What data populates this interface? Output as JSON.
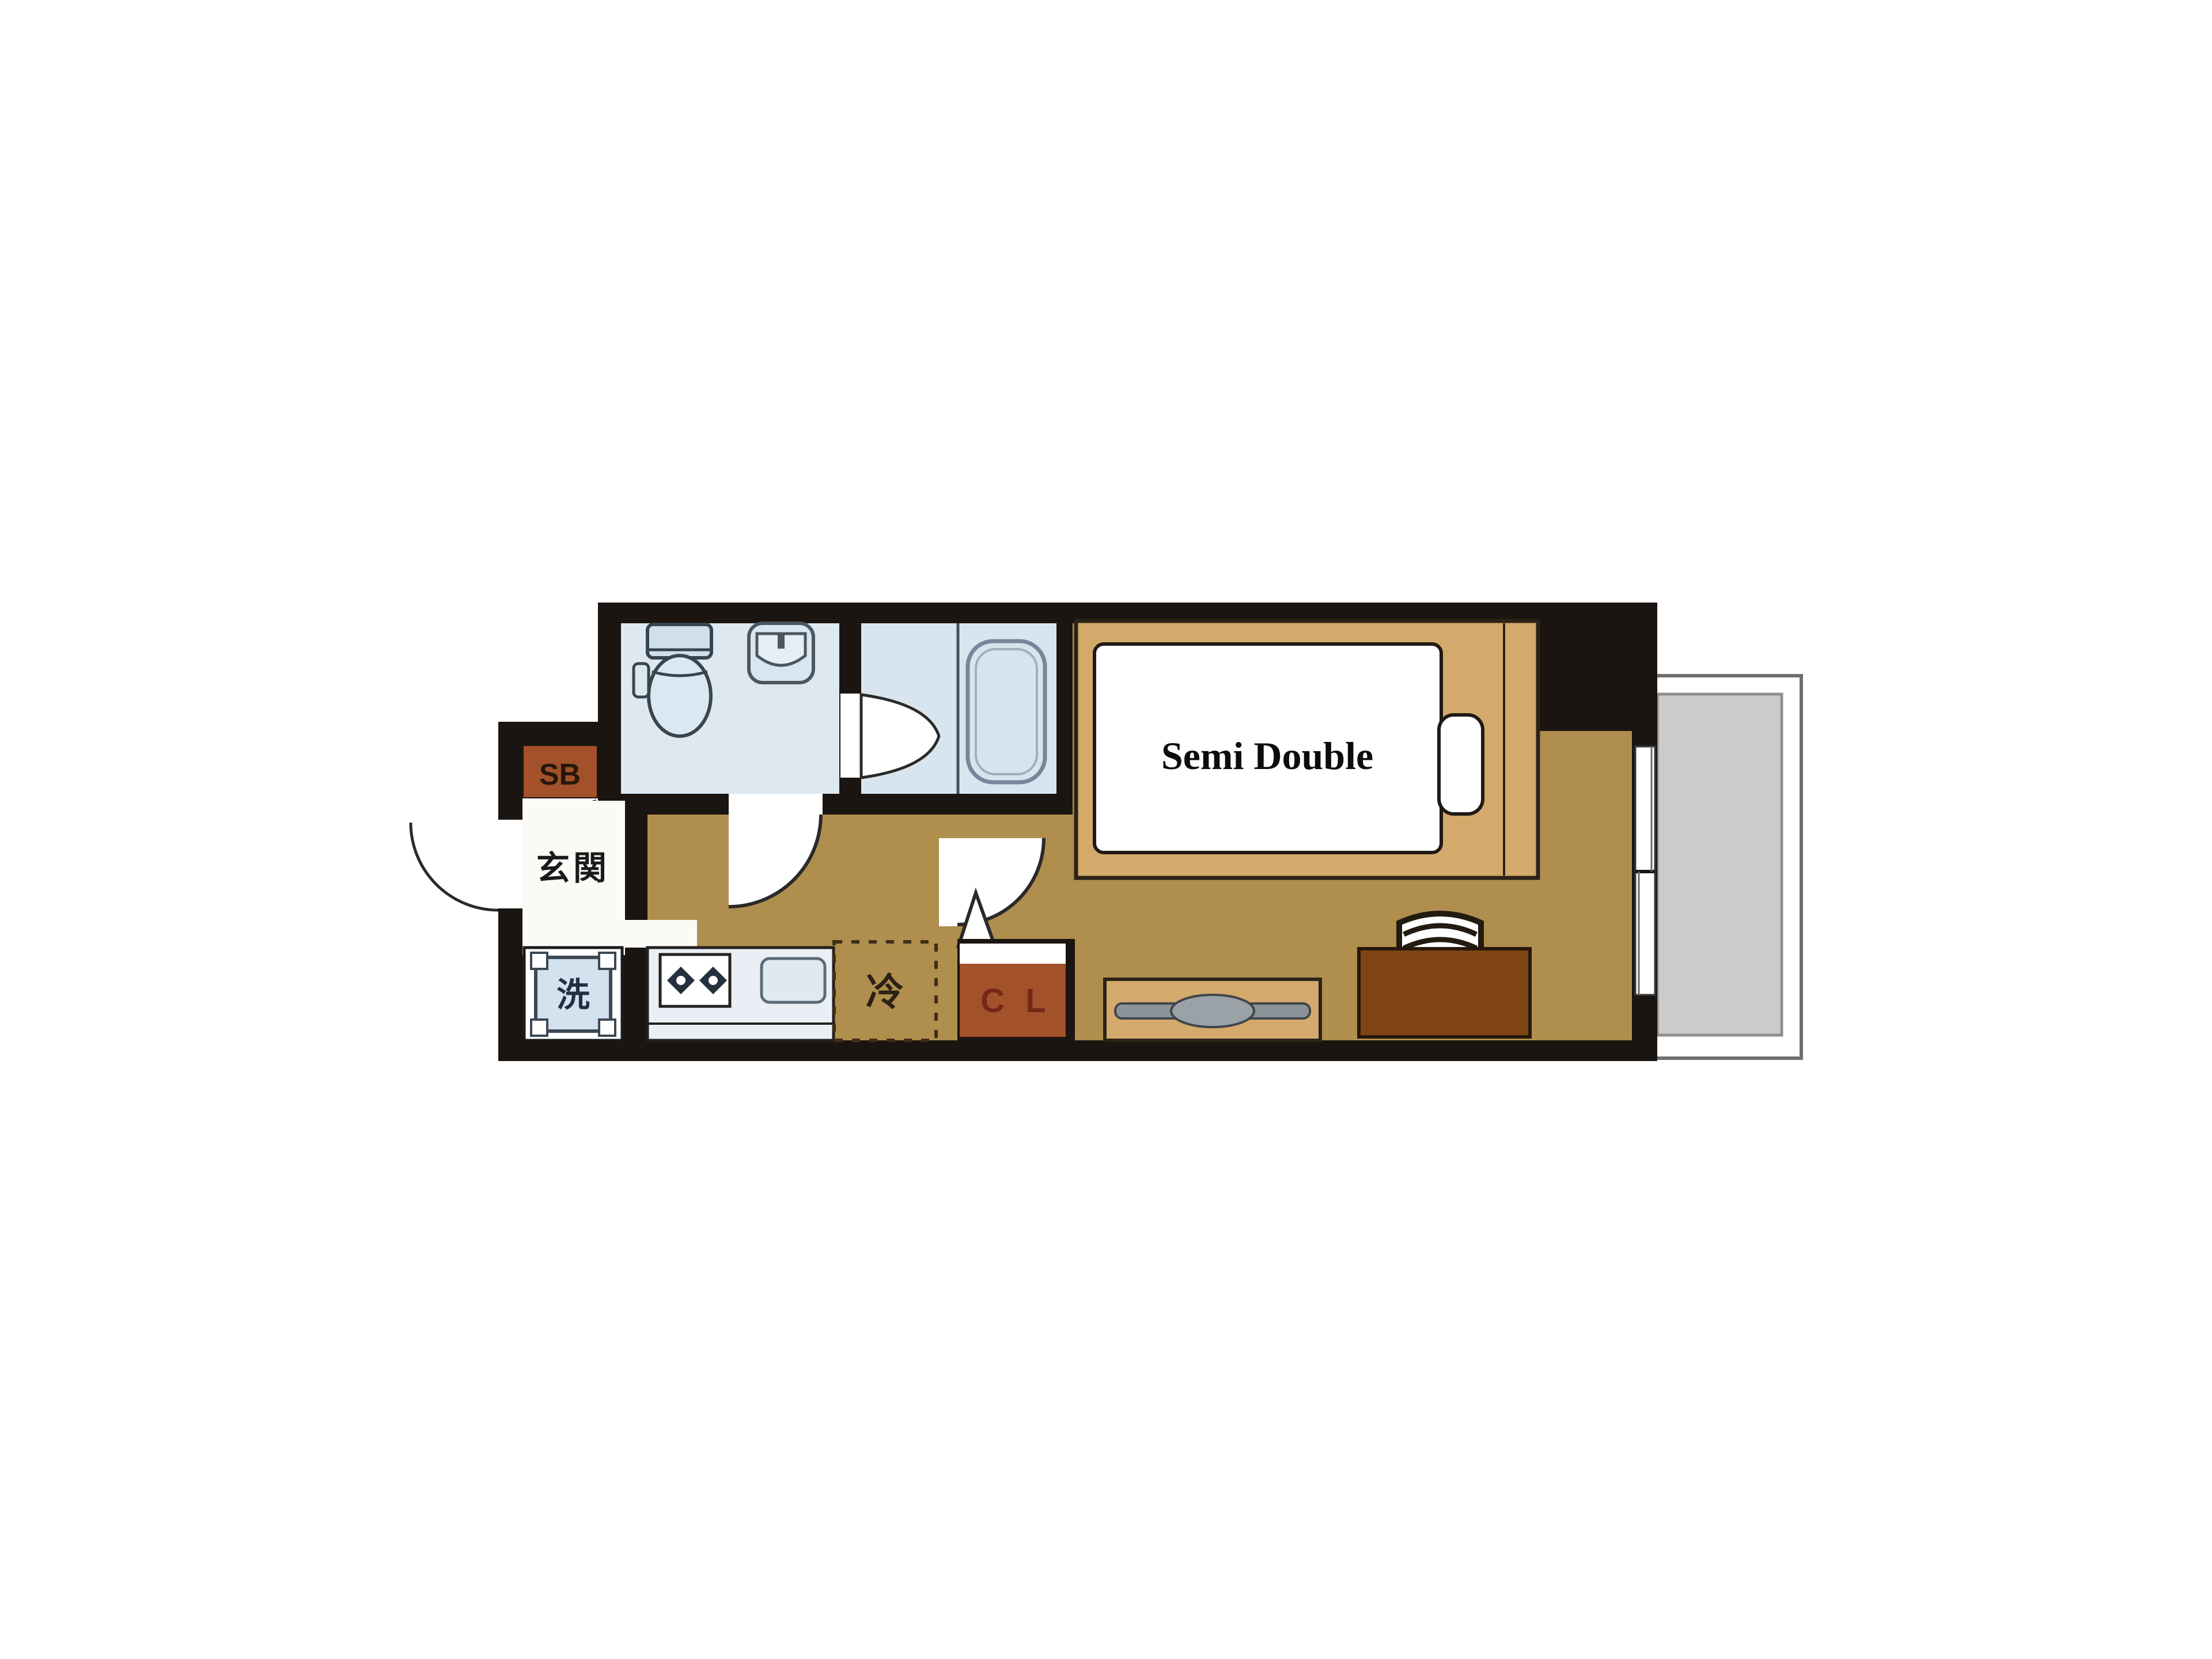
{
  "plan": {
    "title": "apartment-floor-plan",
    "labels": {
      "entrance": "玄関",
      "shoe_box": "SB",
      "washing_machine": "洗",
      "refrigerator": "冷",
      "closet": "C L",
      "bed": "Semi Double"
    },
    "colors": {
      "wall": "#1b1511",
      "floor_olive": "#af8e4e",
      "wet_room_blue": "#dde8f0",
      "fixture_blue": "#d3e2ee",
      "fixture_outline": "#42505c",
      "brown_box": "#a3512a",
      "bed_frame_tan": "#d4a96c",
      "desk_brown": "#7f4516",
      "tv_gray": "#8b9399",
      "balcony_gray": "#cbcbcb",
      "door_line": "#2a2a28",
      "white": "#ffffff"
    }
  }
}
